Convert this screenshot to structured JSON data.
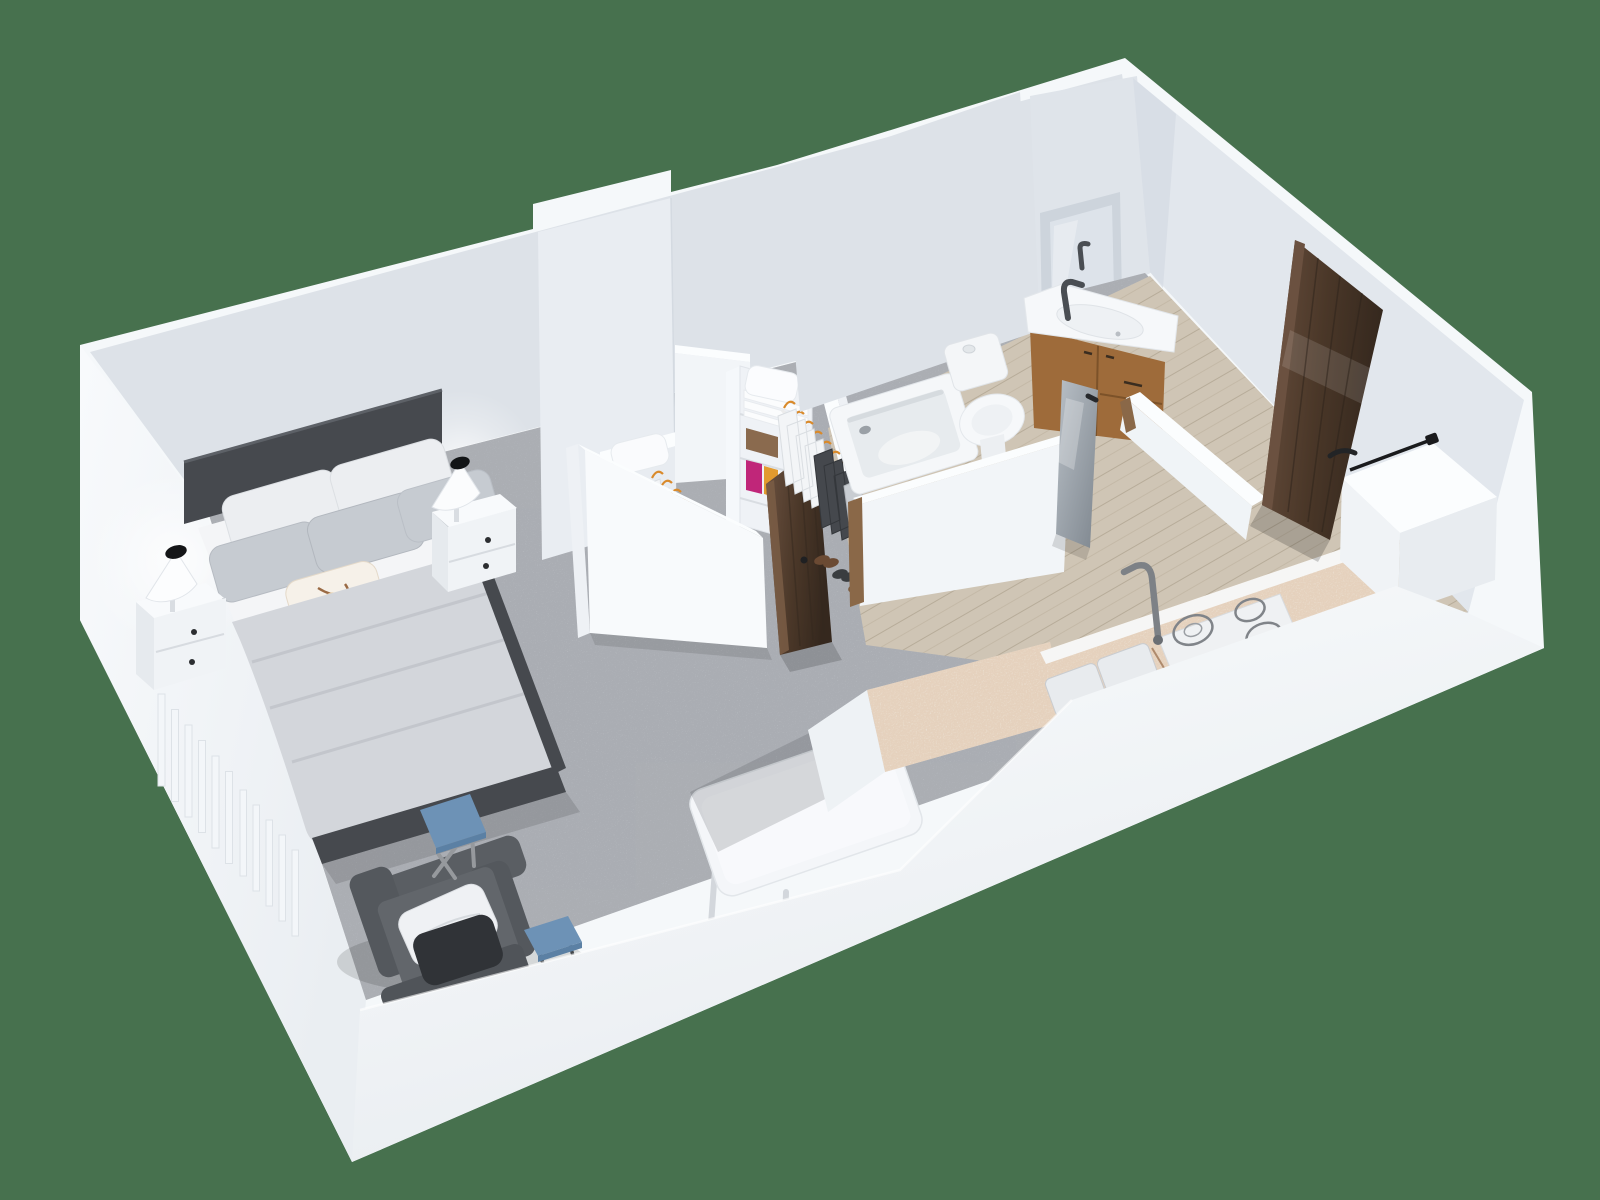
{
  "image": {
    "kind": "3d-floorplan-render",
    "description": "Isometric 3D rendering of a studio apartment floor plan seen from above, on a plain green backdrop. No text is rendered in the image.",
    "width_px": 1600,
    "height_px": 1200
  },
  "palette": {
    "bg": "#47714e",
    "wall_outer": "#f5f8fa",
    "wall_front_top": "#fbfdfe",
    "wall_front_bottom": "#e7ebef",
    "wall_int": "#dde2e8",
    "wall_int2": "#e2e7ed",
    "wall_face": "#e9edf2",
    "wall_bright": "#f2f5f8",
    "band": "#fbfdfe",
    "carpet": "#c0c4c9",
    "carpet_speck": "#55585c",
    "wood_floor": "#cfc5b5",
    "wood_line": "#b7ac99",
    "granite": "#ece2d4",
    "granite_speck": "#c2936c",
    "bed_frame": "#46494e",
    "sheet": "#f4f5f7",
    "duvet": "#d3d6db",
    "pillow_gray": "#c6cbd1",
    "pillow_white": "#eceef1",
    "accent_flower": "#dd5a2b",
    "accent_branch": "#9a6a44",
    "blue": "#6d92b6",
    "chair": "#5a5e63",
    "chair2": "#62666b",
    "cushion_dark": "#303337",
    "walnut_light": "#6b5140",
    "walnut_dark": "#35281e",
    "vanity_wood": "#9e6b3a",
    "hanger": "#d98a2b",
    "magenta": "#c02679",
    "shelf_orange": "#e29a2e",
    "glass_light": "#b9c0c7",
    "glass_dark": "#7e868e"
  },
  "scene": {
    "backdrop": "solid green",
    "rooms": [
      {
        "name": "bedroom-living",
        "floor": "speckled gray carpet",
        "items": [
          "double bed, dark charcoal frame",
          "white sheet and light gray duvet",
          "4 gray pillows + 2 white pillows",
          "floral accent pillow (orange/brown on cream)",
          "white nightstand left (2 drawers)",
          "white nightstand right (2 drawers)",
          "2 white cone lamps with black top",
          "wall radiator with vertical slats",
          "dark gray armchair with white and black cushions",
          "blue folding side table at bed foot",
          "second blue folding table at front wall",
          "white rounded dining table with thin legs"
        ]
      },
      {
        "name": "walk-in-closet",
        "floor": "speckled gray carpet",
        "items": [
          "tall wall stub",
          "shelf ledge with white pillow",
          "hanging rail 1: white shirts, dark garments, empty orange hangers",
          "white shelving unit with folded linens, brown stack, magenta and orange pieces",
          "hanging rail 2: white shirts and dark garments on orange hangers",
          "three pairs of shoes",
          "low pony wall",
          "dark walnut door standing ajar"
        ]
      },
      {
        "name": "bathroom",
        "floor": "light oak planks",
        "items": [
          "built-in white bathtub with drain",
          "toilet with tank and button",
          "walnut vanity cabinet with white basin",
          "dark mixer tap",
          "recessed mirror niche",
          "gray glass door ajar",
          "two low partition walls with wooden end caps"
        ]
      },
      {
        "name": "kitchen-entry",
        "floor": "light oak planks",
        "items": [
          "L-shaped counter with speckled granite top",
          "white cooktop with 4 burner rings",
          "double sink with gray mixer tap",
          "white refrigerator volume with thin black handle",
          "dark walnut entry door with black lever handle"
        ]
      }
    ]
  }
}
